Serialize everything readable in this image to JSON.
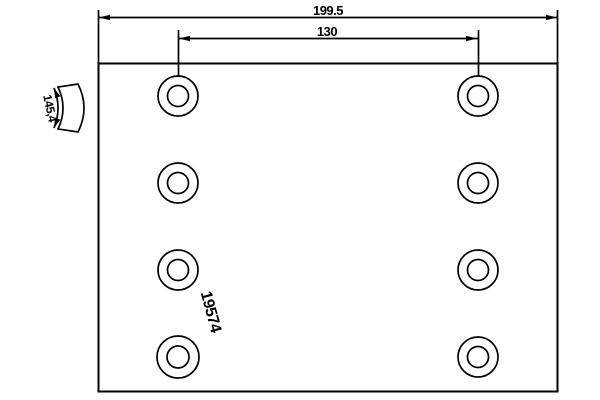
{
  "drawing": {
    "type": "technical-drawing-brake-lining",
    "background": "#ffffff",
    "line_color": "#000000",
    "labels": {
      "overall_length": "199.5",
      "hole_pitch": "130",
      "arc_width": "145,4",
      "part_number": "19574"
    },
    "holes": {
      "count": 8,
      "columns": 2,
      "rows": 4
    }
  }
}
